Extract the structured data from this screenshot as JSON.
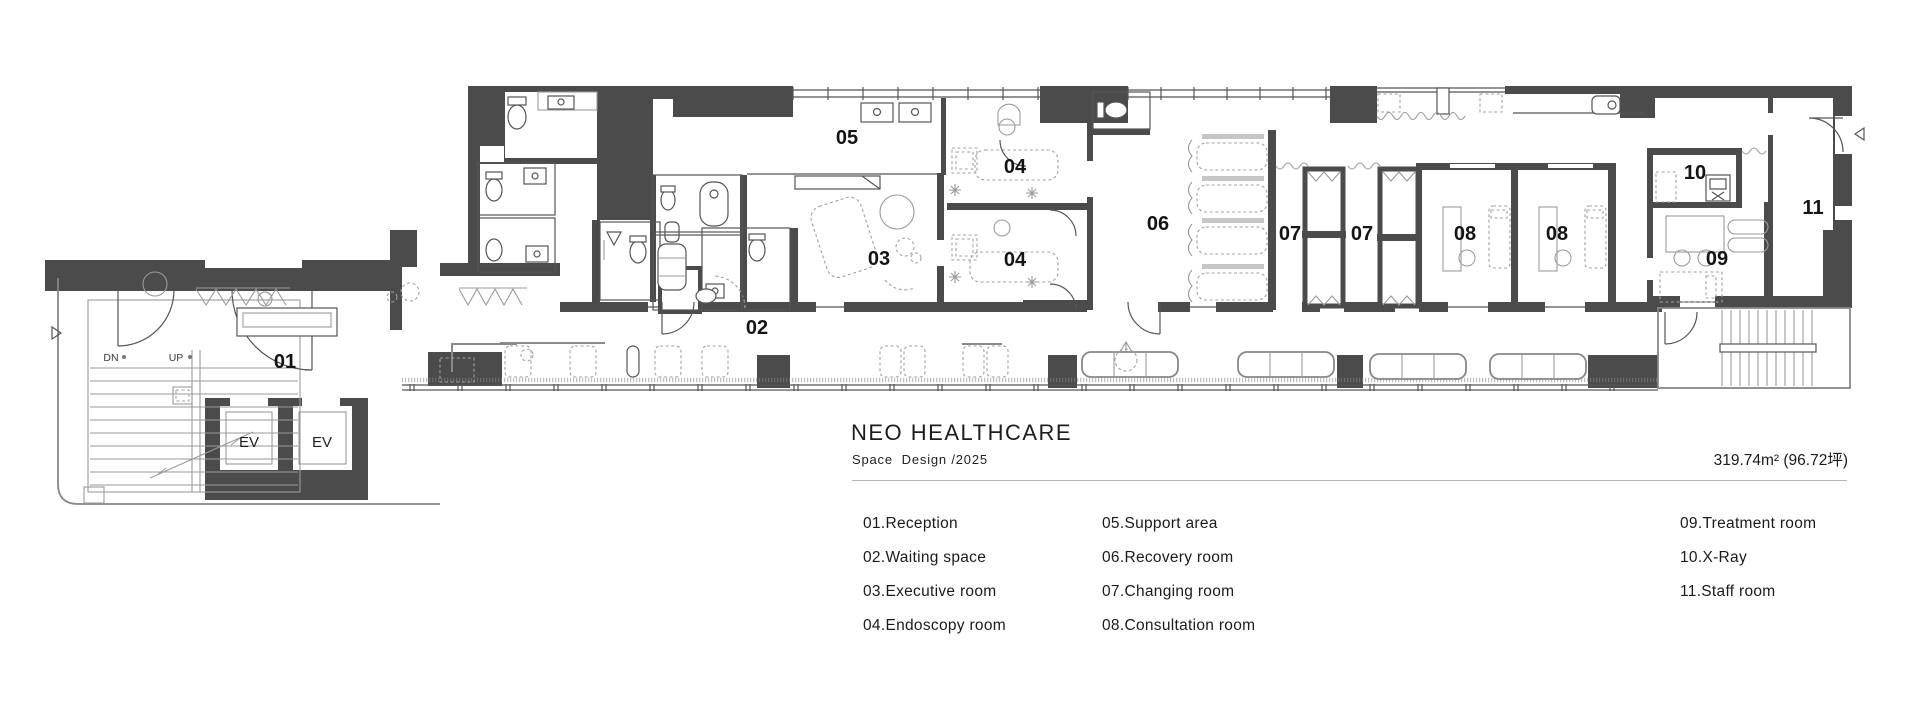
{
  "title_block": {
    "title": "NEO HEALTHCARE",
    "subtitle": "Space  Design /2025",
    "area": "319.74m² (96.72坪)"
  },
  "legend": {
    "columns": [
      [
        "01.Reception",
        "02.Waiting space",
        "03.Executive room",
        "04.Endoscopy room"
      ],
      [
        "05.Support area",
        "06.Recovery room",
        "07.Changing room",
        "08.Consultation room"
      ],
      [
        "09.Treatment room",
        "10.X-Ray",
        "11.Staff room"
      ]
    ]
  },
  "plan": {
    "room_labels": [
      {
        "id": "01",
        "x": 285,
        "y": 368
      },
      {
        "id": "02",
        "x": 757,
        "y": 334
      },
      {
        "id": "03",
        "x": 879,
        "y": 265
      },
      {
        "id": "04",
        "x": 1015,
        "y": 173
      },
      {
        "id": "04",
        "x": 1015,
        "y": 266
      },
      {
        "id": "05",
        "x": 847,
        "y": 144
      },
      {
        "id": "06",
        "x": 1158,
        "y": 230
      },
      {
        "id": "07",
        "x": 1290,
        "y": 240
      },
      {
        "id": "07",
        "x": 1362,
        "y": 240
      },
      {
        "id": "08",
        "x": 1465,
        "y": 240
      },
      {
        "id": "08",
        "x": 1557,
        "y": 240
      },
      {
        "id": "09",
        "x": 1717,
        "y": 265
      },
      {
        "id": "10",
        "x": 1695,
        "y": 179
      },
      {
        "id": "11",
        "x": 1813,
        "y": 214
      }
    ],
    "elevator_labels": [
      {
        "text": "EV",
        "x": 249,
        "y": 447
      },
      {
        "text": "EV",
        "x": 322,
        "y": 447
      }
    ],
    "stair_labels": [
      {
        "text": "DN",
        "x": 111,
        "y": 361
      },
      {
        "text": "UP",
        "x": 176,
        "y": 361
      }
    ]
  }
}
